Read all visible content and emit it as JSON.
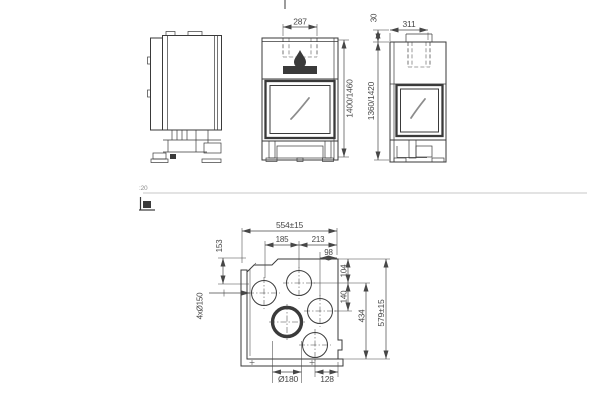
{
  "colors": {
    "line": "#3a3a3a",
    "dim": "#474747",
    "muted": "#8f8f8f",
    "bg": "#ffffff"
  },
  "scale": {
    "label": ":20"
  },
  "front_view": {
    "flue_width": "287",
    "height": "1400/1460"
  },
  "side_view": {
    "flue_depth": "311",
    "collar": "30",
    "height": "1360/1420"
  },
  "plan_view": {
    "overall_width": "554±15",
    "dim_185": "185",
    "dim_213": "213",
    "dim_98": "98",
    "dim_153": "153",
    "holes_label": "4xØ150",
    "dim_104": "104",
    "dim_140": "140",
    "dim_434": "434",
    "overall_depth": "579±15",
    "big_hole": "Ø180",
    "dim_128": "128"
  }
}
